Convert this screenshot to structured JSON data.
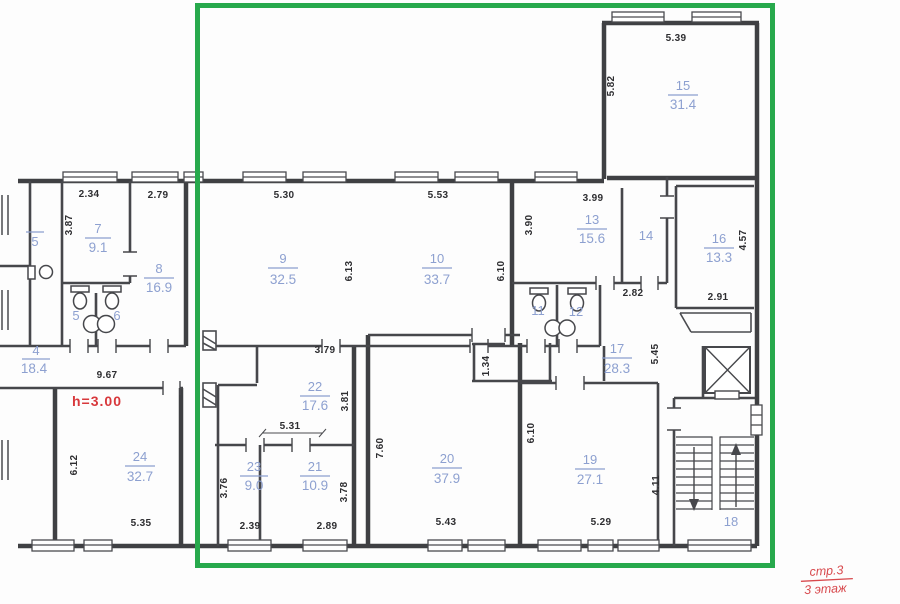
{
  "highlight": {
    "color": "#27a94c"
  },
  "palette": {
    "wall": "#3f4043",
    "label_blue": "#8da0d0",
    "dim_text": "#2e2e31",
    "annotation_red": "#d8383c"
  },
  "rooms": [
    {
      "id": "15",
      "n": "15",
      "a": "31.4"
    },
    {
      "id": "13",
      "n": "13",
      "a": "15.6"
    },
    {
      "id": "14",
      "n": "14",
      "a": ""
    },
    {
      "id": "16",
      "n": "16",
      "a": "13.3"
    },
    {
      "id": "7",
      "n": "7",
      "a": "9.1"
    },
    {
      "id": "8",
      "n": "8",
      "a": "16.9"
    },
    {
      "id": "5",
      "n": "5",
      "a": ""
    },
    {
      "id": "6",
      "n": "6",
      "a": ""
    },
    {
      "id": "9",
      "n": "9",
      "a": "32.5"
    },
    {
      "id": "10",
      "n": "10",
      "a": "33.7"
    },
    {
      "id": "11",
      "n": "11",
      "a": ""
    },
    {
      "id": "12",
      "n": "12",
      "a": ""
    },
    {
      "id": "17",
      "n": "17",
      "a": "28.3"
    },
    {
      "id": "22",
      "n": "22",
      "a": "17.6"
    },
    {
      "id": "23",
      "n": "23",
      "a": "9.0"
    },
    {
      "id": "21",
      "n": "21",
      "a": "10.9"
    },
    {
      "id": "20",
      "n": "20",
      "a": "37.9"
    },
    {
      "id": "19",
      "n": "19",
      "a": "27.1"
    },
    {
      "id": "24",
      "n": "24",
      "a": "32.7"
    },
    {
      "id": "18",
      "n": "18",
      "a": ""
    },
    {
      "id": "4",
      "n": "4",
      "a": "18.4"
    },
    {
      "id": "5-partial",
      "n": "5",
      "a": ""
    }
  ],
  "dims": [
    "5.39",
    "2.34",
    "2.79",
    "5.30",
    "5.53",
    "3.99",
    "2.82",
    "2.91",
    "3.79",
    "5.31",
    "9.67",
    "2.39",
    "2.89",
    "5.43",
    "5.29",
    "5.35",
    "5.82",
    "3.87",
    "3.90",
    "6.13",
    "6.10",
    "4.57",
    "5.45",
    "3.81",
    "1.34",
    "7.60",
    "6.10",
    "6.12",
    "3.76",
    "3.78",
    "4.11"
  ],
  "annotations": {
    "ceiling_height": "h=3.00",
    "page_ref": "стр.3",
    "floor_ref": "3 этаж"
  }
}
